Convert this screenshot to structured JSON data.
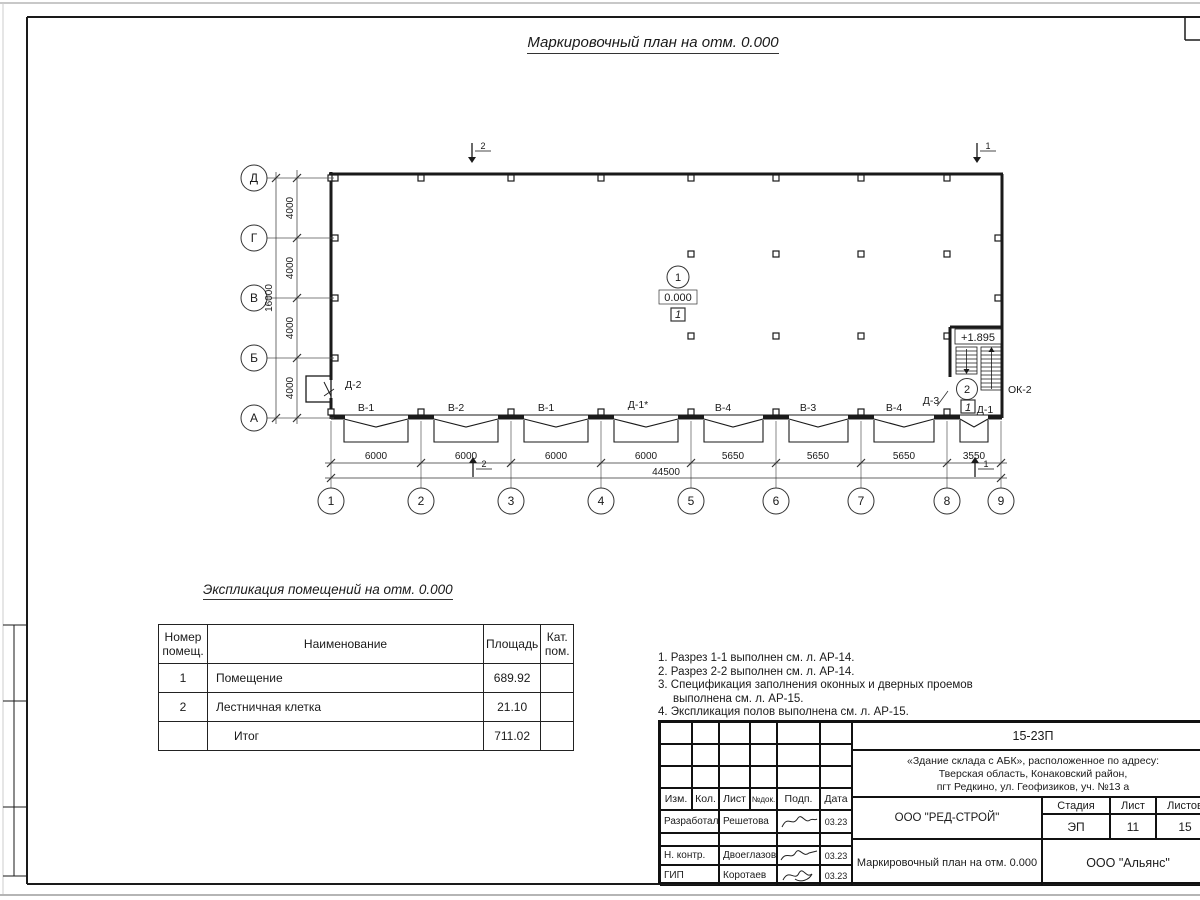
{
  "title": "Маркировочный план на отм. 0.000",
  "plan": {
    "axes_rows": [
      "Д",
      "Г",
      "В",
      "Б",
      "А"
    ],
    "axes_cols": [
      "1",
      "2",
      "3",
      "4",
      "5",
      "6",
      "7",
      "8",
      "9"
    ],
    "dims_v": [
      "4000",
      "4000",
      "4000",
      "4000"
    ],
    "dim_v_total": "16000",
    "dims_h": [
      "6000",
      "6000",
      "6000",
      "6000",
      "5650",
      "5650",
      "5650",
      "3550"
    ],
    "dim_h_total": "44500",
    "openings": [
      "В-1",
      "В-2",
      "В-1",
      "Д-1*",
      "В-4",
      "В-3",
      "В-4"
    ],
    "door_d2": "Д-2",
    "door_d3": "Д-3",
    "door_d1": "Д-1",
    "window_ok2": "ОК-2",
    "room1_num": "1",
    "room1_elev": "0.000",
    "room1_cat": "1",
    "room2_num": "2",
    "room2_elev": "+1.895",
    "room2_cat": "1",
    "section1": "1",
    "section2": "2"
  },
  "explication": {
    "title": "Экспликация помещений на отм. 0.000",
    "headers": {
      "num": "Номер помещ.",
      "name": "Наименование",
      "area": "Площадь",
      "cat": "Кат. пом."
    },
    "rows": [
      {
        "num": "1",
        "name": "Помещение",
        "area": "689.92",
        "cat": ""
      },
      {
        "num": "2",
        "name": "Лестничная клетка",
        "area": "21.10",
        "cat": ""
      },
      {
        "num": "",
        "name": "Итог",
        "area": "711.02",
        "cat": ""
      }
    ]
  },
  "notes": [
    "1. Разрез 1-1 выполнен см. л. АР-14.",
    "2. Разрез 2-2 выполнен см. л. АР-14.",
    "3. Спецификация заполнения оконных и дверных проемов выполнена см. л. АР-15.",
    "4. Экспликация полов выполнена см. л. АР-15."
  ],
  "titleblock": {
    "doc_number": "15-23П",
    "address_line1": "«Здание склада с АБК», расположенное по адресу:",
    "address_line2": "Тверская область, Конаковский район,",
    "address_line3": "пгт Редкино, ул. Геофизиков, уч. №13 а",
    "header_cols": {
      "izm": "Изм.",
      "kol": "Кол.",
      "list": "Лист",
      "ndoc": "№док.",
      "podp": "Подп.",
      "data": "Дата"
    },
    "rows": [
      {
        "role": "Разработал",
        "name": "Решетова",
        "date": "03.23"
      },
      {
        "role": "Н. контр.",
        "name": "Двоеглазов",
        "date": "03.23"
      },
      {
        "role": "ГИП",
        "name": "Коротаев",
        "date": "03.23"
      }
    ],
    "org": "ООО \"РЕД-СТРОЙ\"",
    "sheet_title": "Маркировочный план на отм. 0.000",
    "stage_label": "Стадия",
    "sheet_label": "Лист",
    "sheets_label": "Листов",
    "stage": "ЭП",
    "sheet_no": "11",
    "sheets_total": "15",
    "company": "ООО \"Альянс\""
  }
}
